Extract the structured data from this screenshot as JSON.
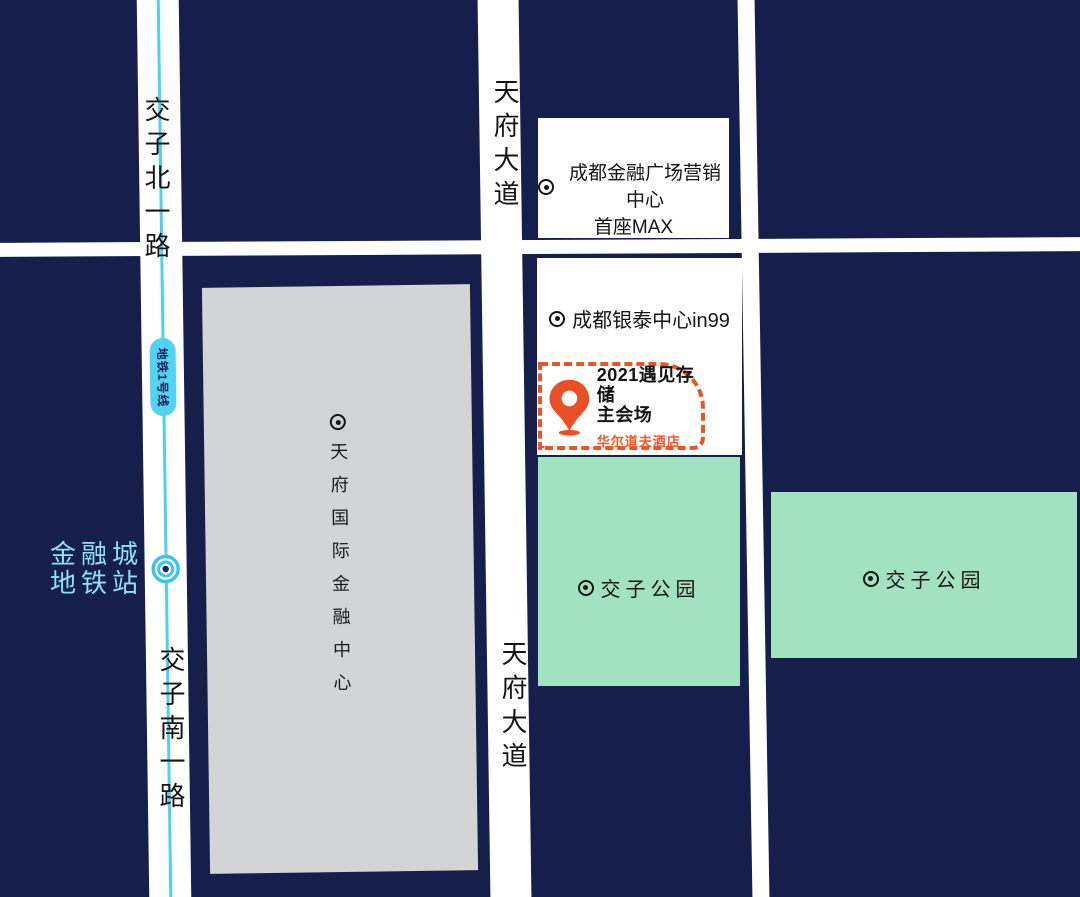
{
  "colors": {
    "background": "#161e4b",
    "road": "#ffffff",
    "park": "#a2e2c1",
    "building": "#d2d4d6",
    "metro_line": "#4fd0f0",
    "metro_pill": "#53d2f2",
    "metro_station_text": "#8fe1f5",
    "accent_orange": "#ea5428",
    "text_dark": "#141414"
  },
  "roads": {
    "jiaozi_north": "交子北一路",
    "jiaozi_south": "交子南一路",
    "tianfu_avenue_top": "天府大道",
    "tianfu_avenue_bottom": "天府大道"
  },
  "metro": {
    "line_label": "地铁1号线",
    "station_name_line1": "金融城",
    "station_name_line2": "地铁站"
  },
  "places": {
    "finance_center": "天府国际金融中心",
    "marketing_center_line1": "成都金融广场营销中心",
    "marketing_center_line2": "首座MAX",
    "in99": "成都银泰中心in99",
    "park_west": "交子公园",
    "park_east": "交子公园"
  },
  "venue": {
    "title_line1": "2021遇见存储",
    "title_line2": "主会场",
    "hotel": "华尔道夫酒店"
  }
}
